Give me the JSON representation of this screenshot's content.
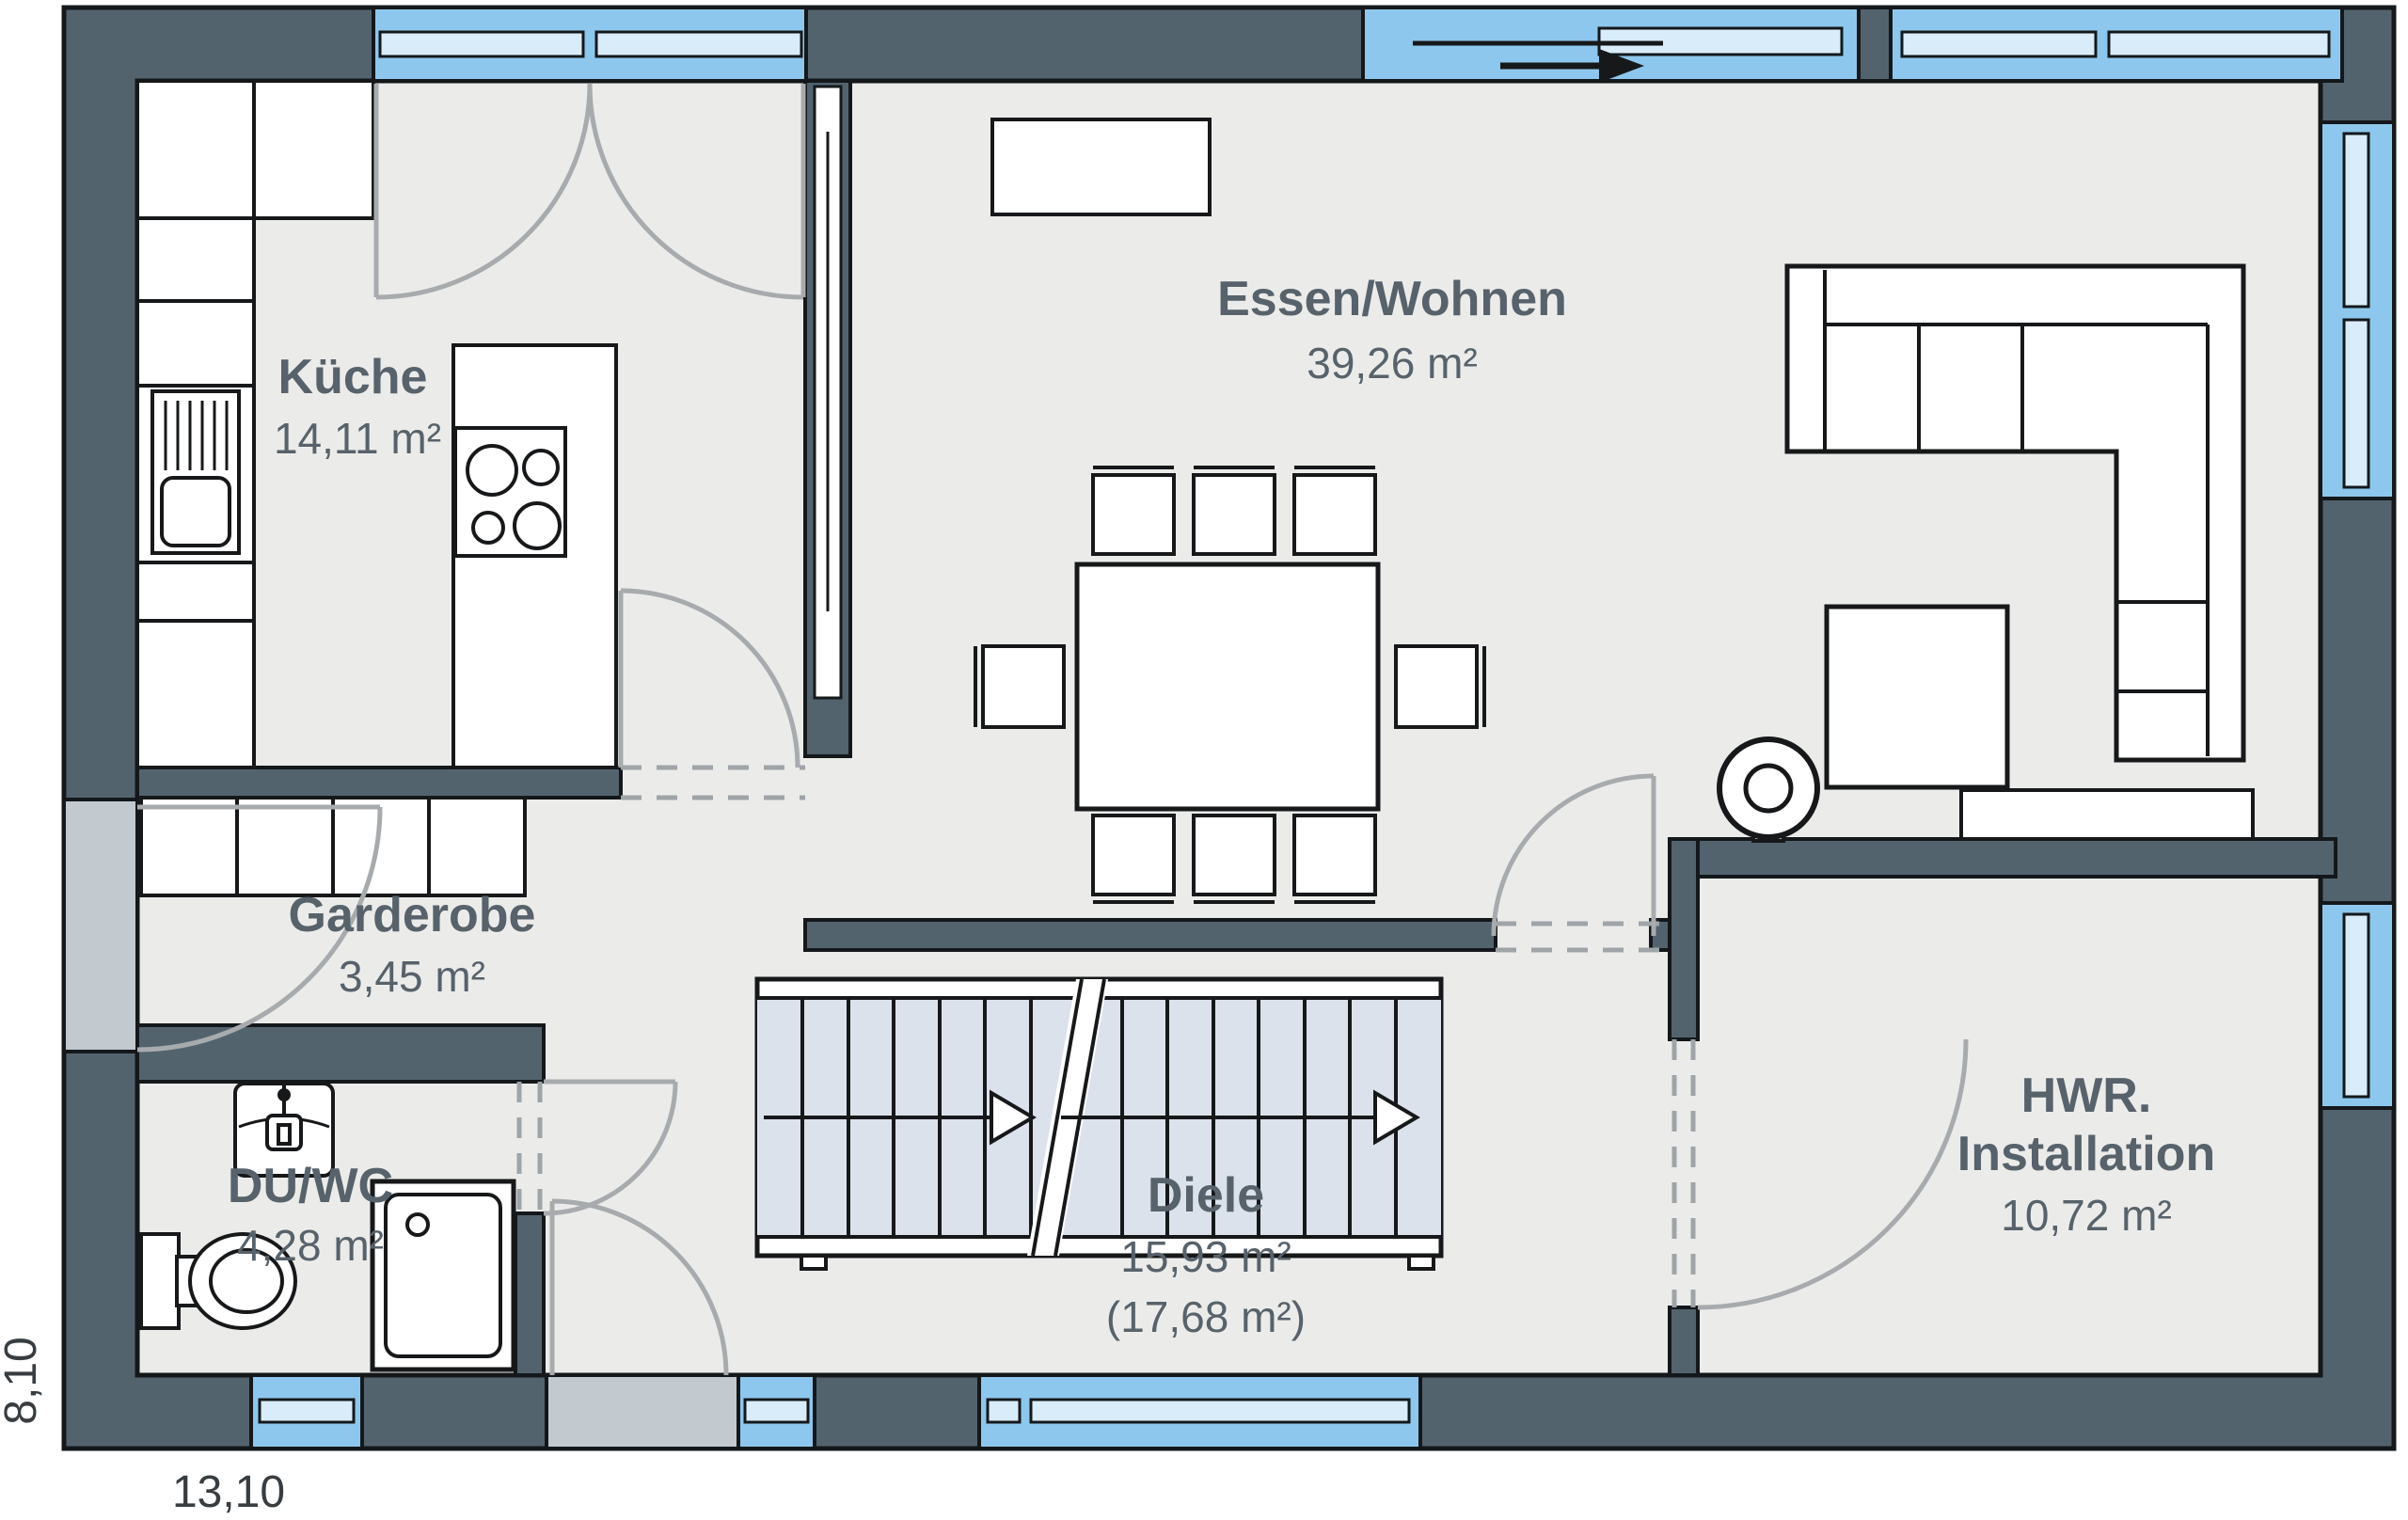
{
  "rooms": {
    "kueche": {
      "name": "Küche",
      "area": "14,11 m²"
    },
    "essen_wohnen": {
      "name": "Essen/Wohnen",
      "area": "39,26 m²"
    },
    "garderobe": {
      "name": "Garderobe",
      "area": "3,45 m²"
    },
    "du_wc": {
      "name": "DU/WC",
      "area": "4,28 m²"
    },
    "diele": {
      "name": "Diele",
      "area": "15,93 m²",
      "area_gross": "(17,68 m²)"
    },
    "hwr": {
      "name": "HWR.",
      "name_line2": "Installation",
      "area": "10,72 m²"
    }
  },
  "dimensions": {
    "width_m": "13,10",
    "height_m": "8,10"
  },
  "colors": {
    "wall": "#53636e",
    "outline": "#14181b",
    "floor": "#ebecea",
    "window_glass": "#8ec7ed",
    "window_pane": "#d9ecfa",
    "entry_door": "#c2c9cf",
    "stair_tread": "#dbe2ec",
    "door_arc": "#a8abad",
    "room_label": "#57626b"
  }
}
